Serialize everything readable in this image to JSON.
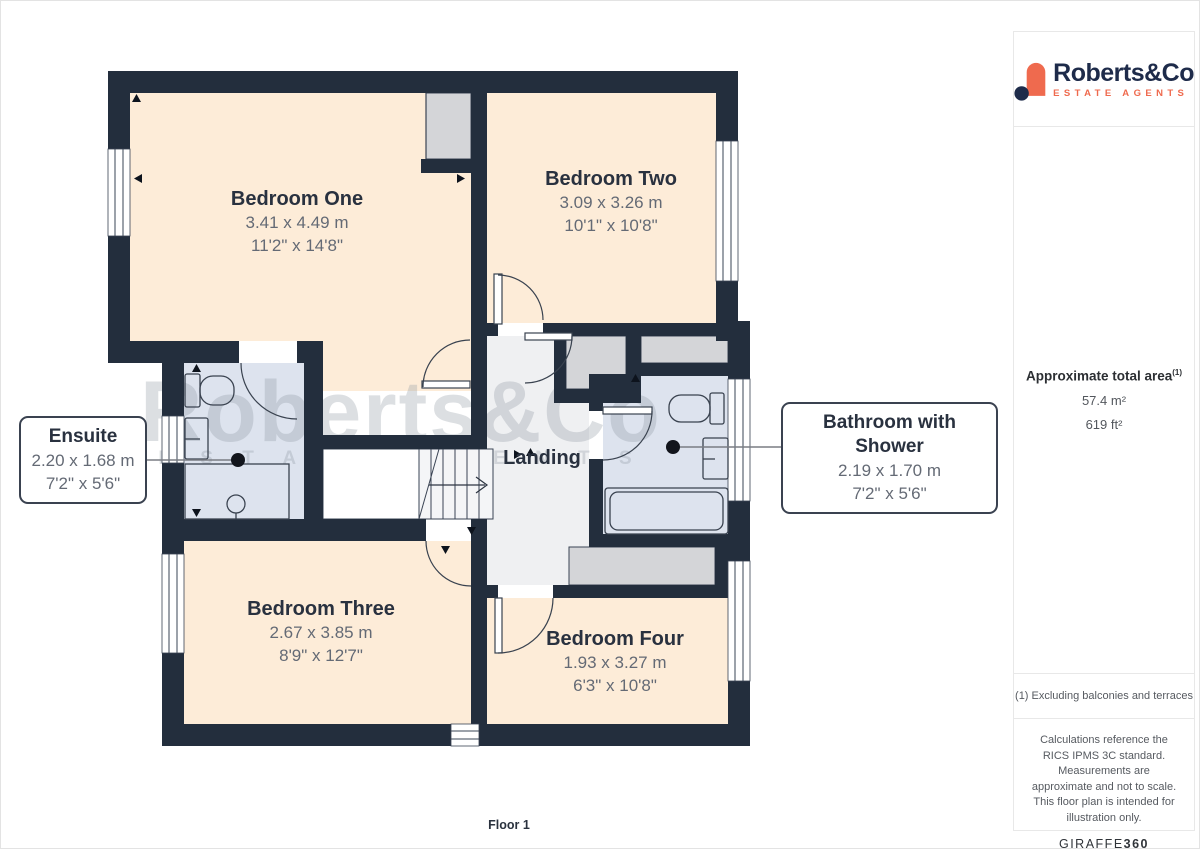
{
  "branding": {
    "name": "Roberts&Co",
    "tagline": "ESTATE AGENTS",
    "navy": "#1e2b4a",
    "orange": "#ef6a4e"
  },
  "sidebar": {
    "area": {
      "title": "Approximate total area",
      "superscript": "(1)",
      "metric_value": "57.4 m²",
      "imperial_value": "619 ft²"
    },
    "footnote": "(1) Excluding balconies and terraces",
    "legal": "Calculations reference the RICS IPMS 3C standard. Measurements are approximate and not to scale. This floor plan is intended for illustration only.",
    "provider": {
      "name": "GIRAFFE",
      "suffix": "360"
    }
  },
  "floor_label": "Floor 1",
  "watermark": {
    "line1": "Roberts&Co",
    "line2": "E S T A T E   A G E N T S"
  },
  "rooms": [
    {
      "id": "bedroom-one",
      "name": "Bedroom One",
      "metric": "3.41 x 4.49 m",
      "imperial": "11'2\" x 14'8\""
    },
    {
      "id": "bedroom-two",
      "name": "Bedroom Two",
      "metric": "3.09 x 3.26 m",
      "imperial": "10'1\" x 10'8\""
    },
    {
      "id": "landing",
      "name": "Landing"
    },
    {
      "id": "bedroom-three",
      "name": "Bedroom Three",
      "metric": "2.67 x 3.85 m",
      "imperial": "8'9\" x 12'7\""
    },
    {
      "id": "bedroom-four",
      "name": "Bedroom Four",
      "metric": "1.93 x 3.27 m",
      "imperial": "6'3\" x 10'8\""
    }
  ],
  "callouts": [
    {
      "id": "ensuite",
      "name": "Ensuite",
      "metric": "2.20 x 1.68 m",
      "imperial": "7'2\" x 5'6\""
    },
    {
      "id": "bathroom",
      "name": "Bathroom with Shower",
      "metric": "2.19 x 1.70 m",
      "imperial": "7'2\" x 5'6\""
    }
  ],
  "colors": {
    "wall": "#232e3d",
    "bedroom_fill": "#fdecd8",
    "bathroom_fill": "#dde3ee",
    "landing_fill": "#eff0f2",
    "closet_fill": "#d4d5d8",
    "label_dark": "#29313f",
    "label_gray": "#646a75"
  }
}
